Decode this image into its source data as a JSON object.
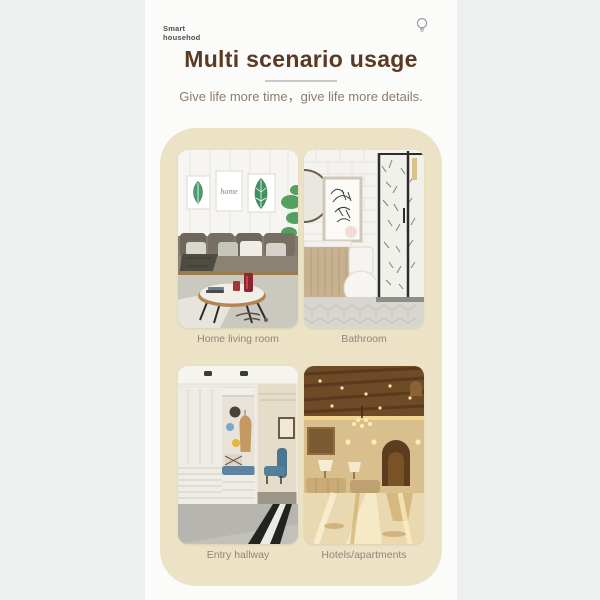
{
  "page": {
    "bg_color": "#eef0ef",
    "panel_color": "#fbfbf9"
  },
  "header": {
    "brand_line1": "Smart",
    "brand_line2": "househod",
    "icon": "lightbulb-icon",
    "icon_color": "#9a9a9a"
  },
  "hero": {
    "title": "Multi scenario usage",
    "title_color": "#5a3a23",
    "divider_color": "#c9c8c6",
    "subtitle": "Give life more time，give life more details.",
    "subtitle_color": "#8d7c6d"
  },
  "scenarios": {
    "card_color": "#ece2c6",
    "caption_color": "#8e887a",
    "photo_texts": {
      "living_room_frame": "home"
    },
    "items": [
      {
        "label": "Home living room",
        "image": "living-room-photo"
      },
      {
        "label": "Bathroom",
        "image": "bathroom-photo"
      },
      {
        "label": "Entry hallway",
        "image": "entry-hallway-photo"
      },
      {
        "label": "Hotels/apartments",
        "image": "hotel-lobby-photo"
      }
    ]
  }
}
